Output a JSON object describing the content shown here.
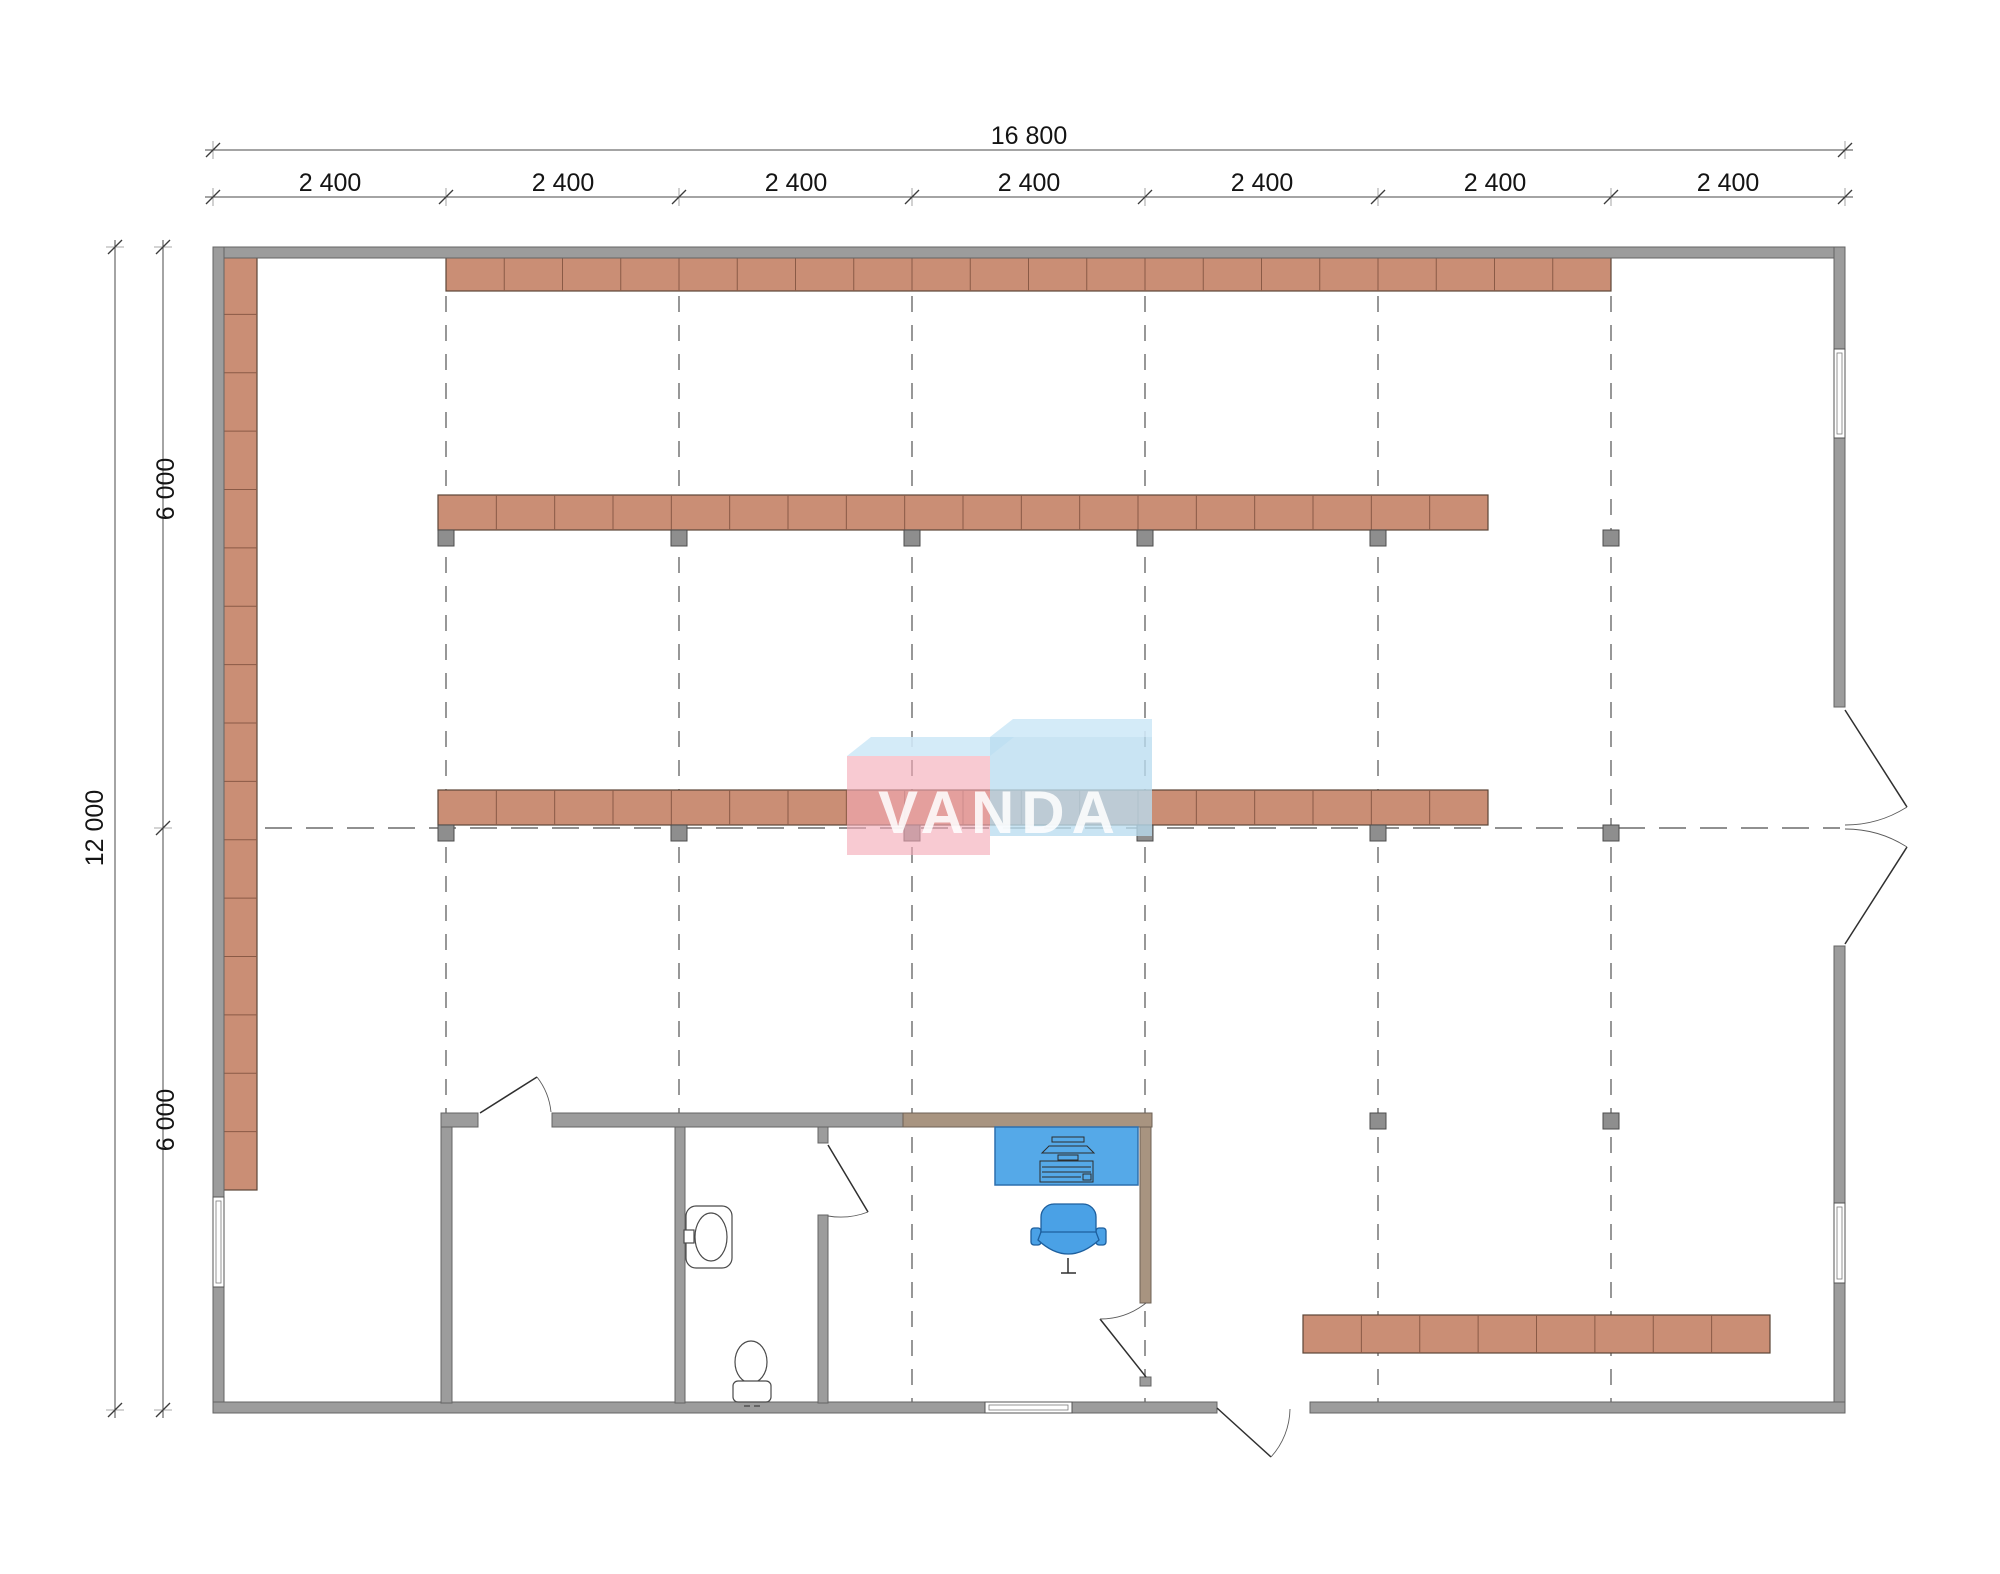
{
  "drawing": {
    "type": "floor-plan",
    "dims": {
      "total_width": "16 800",
      "segments": [
        "2 400",
        "2 400",
        "2 400",
        "2 400",
        "2 400",
        "2 400",
        "2 400"
      ],
      "total_height": "12 000",
      "half_heights": [
        "6 000",
        "6 000"
      ]
    },
    "logo": {
      "text": "VANDA"
    }
  },
  "colors": {
    "wall": "#9c9c9c",
    "wall_tan": "#a89480",
    "shelf": "#ca8e75",
    "column": "#8e8e8e",
    "grid": "#6b6b6b",
    "desk": "#55a9e8",
    "chair": "#4aa1e6",
    "logo_pink": "#f4aab6",
    "logo_blue": "#badcef",
    "logo_bevel": "#cfe9f7"
  }
}
